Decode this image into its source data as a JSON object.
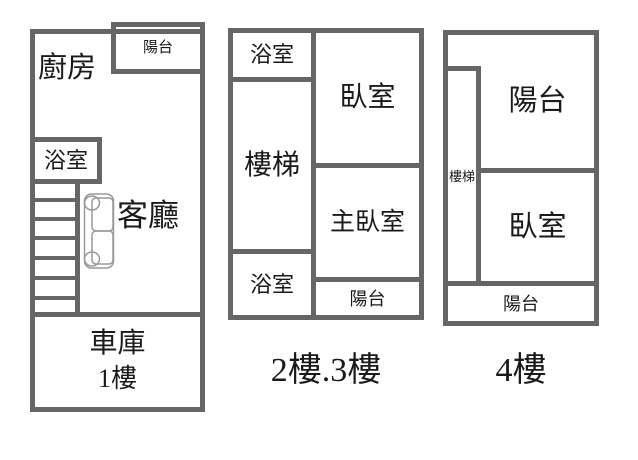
{
  "colors": {
    "wall": "#666666",
    "text": "#1a1a1a",
    "sofa_outline": "#999999",
    "background": "#ffffff"
  },
  "icons": {
    "sofa": "sofa-icon"
  },
  "plan1": {
    "rooms": {
      "kitchen": "廚房",
      "balcony": "陽台",
      "bathroom": "浴室",
      "living_room": "客廳",
      "garage": "車庫",
      "floor_label": "1樓"
    }
  },
  "plan2": {
    "caption": "2樓.3樓",
    "rooms": {
      "bathroom_top": "浴室",
      "stairs": "樓梯",
      "bathroom_bottom": "浴室",
      "bedroom": "臥室",
      "master_bedroom": "主臥室",
      "balcony": "陽台"
    }
  },
  "plan3": {
    "caption": "4樓",
    "rooms": {
      "balcony_top": "陽台",
      "stairs": "樓梯",
      "bedroom": "臥室",
      "balcony_bottom": "陽台"
    }
  }
}
